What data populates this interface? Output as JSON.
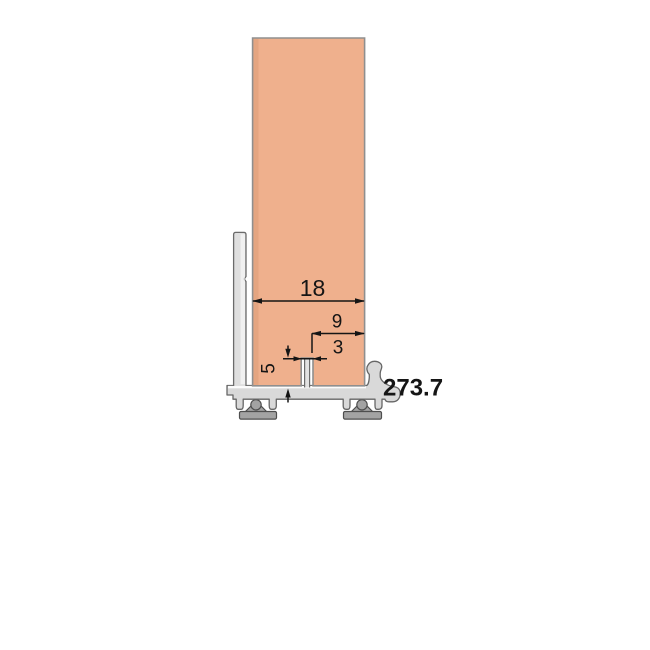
{
  "drawing": {
    "part_number": "273.7",
    "dimensions": {
      "panel_width": "18",
      "groove_offset_right": "9",
      "groove_width": "3",
      "groove_depth": "5"
    },
    "colors": {
      "panel": "#EFB08D",
      "profile": "#DFDFDF",
      "profile_base": "#D9D9D9",
      "glide": "#A3A3A3",
      "outline": "#666666",
      "dimension_line": "#151515",
      "part_number": "#D8262C",
      "background": "#FFFFFF"
    }
  }
}
